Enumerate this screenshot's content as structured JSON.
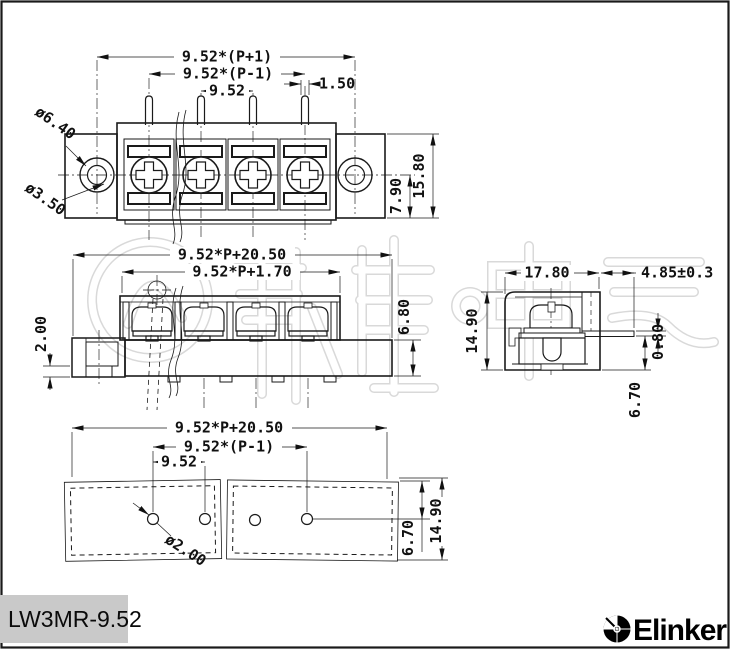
{
  "part_number": "LW3MR-9.52",
  "brand": "Elinker",
  "colors": {
    "line": "#1a1a1a",
    "watermark": "#d9d9d9",
    "label_bg": "#c9c9c9",
    "accent": "#000000"
  },
  "views": {
    "front": {
      "dims": {
        "pitch_total": "9.52*(P+1)",
        "pitch_span": "9.52*(P-1)",
        "pitch": "9.52",
        "pin_width": "1.50",
        "mount_hole_outer": "ø6.40",
        "mount_hole_inner": "ø3.50",
        "total_height": "15.80",
        "center_height": "7.90"
      }
    },
    "side": {
      "dims": {
        "total_length": "9.52*P+20.50",
        "housing_length": "9.52*P+1.70",
        "flange_lip": "2.00",
        "base_height": "6.80"
      }
    },
    "section": {
      "dims": {
        "depth": "17.80",
        "tab_extension": "4.85±0.3",
        "total_height": "14.90",
        "tab_thickness": "0.80",
        "tab_offset": "6.70"
      }
    },
    "footprint": {
      "dims": {
        "total_length": "9.52*P+20.50",
        "pitch_span": "9.52*(P-1)",
        "pitch": "9.52",
        "hole_dia": "ø2.00",
        "hole_edge_offset": "6.70",
        "board_width": "14.90"
      }
    }
  }
}
